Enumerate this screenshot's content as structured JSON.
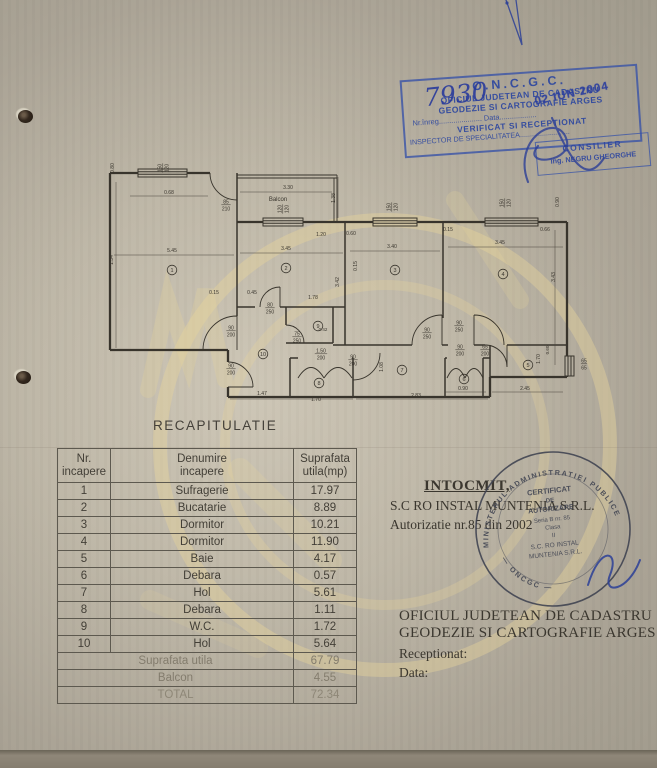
{
  "stamp_oncgc": {
    "title": "O.N.C.G.C.",
    "line1": "OFICIUL JUDETEAN DE CADASTRU",
    "line2": "GEODEZIE SI CARTOGRAFIE ARGES",
    "reg_line": "Nr.înreg..................... Data..................",
    "line3": "VERIFICAT SI RECEPTIONAT",
    "line4": "INSPECTOR DE SPECIALITATEA.........................",
    "handwritten_number": "7930",
    "date_stamp": "02 IUN 2004",
    "ink_color": "#3651a8"
  },
  "stamp_consilier": {
    "line1": "CONSILIER",
    "line2": "ing. NEGRU GHEORGHE"
  },
  "round_stamp": {
    "ring_top": "MINISTERUL  ADMINISTRATIEI  PUBLICE",
    "ring_bottom": "— ONCGC —",
    "center_lines": [
      "CERTIFICAT",
      "DE",
      "AUTORIZARE",
      "Seria B  nr. 85",
      "Clasa",
      "II",
      "S.C. RO INSTAL",
      "MUNTENIA S.R.L."
    ],
    "ink_color": "#3e4250"
  },
  "plan": {
    "rooms": [
      {
        "n": "1",
        "x": 72,
        "y": 110
      },
      {
        "n": "2",
        "x": 186,
        "y": 108
      },
      {
        "n": "3",
        "x": 295,
        "y": 110
      },
      {
        "n": "4",
        "x": 403,
        "y": 114
      },
      {
        "n": "5",
        "x": 428,
        "y": 205
      },
      {
        "n": "6",
        "x": 364,
        "y": 219
      },
      {
        "n": "7",
        "x": 302,
        "y": 210
      },
      {
        "n": "8",
        "x": 219,
        "y": 223
      },
      {
        "n": "9",
        "x": 218,
        "y": 166
      },
      {
        "n": "10",
        "x": 163,
        "y": 194
      }
    ],
    "labels": [
      {
        "t": "150/120",
        "x": 62,
        "y": 8,
        "r": -90,
        "f": 1
      },
      {
        "t": "0.80",
        "x": 14,
        "y": 8,
        "r": -90
      },
      {
        "t": "0.68",
        "x": 69,
        "y": 34
      },
      {
        "t": "1.34",
        "x": 13,
        "y": 100,
        "r": -90
      },
      {
        "t": "5.45",
        "x": 72,
        "y": 92
      },
      {
        "t": "85/210",
        "x": 126,
        "y": 44,
        "f": 1
      },
      {
        "t": "Balcon",
        "x": 178,
        "y": 41,
        "fs": 6
      },
      {
        "t": "3.30",
        "x": 188,
        "y": 29
      },
      {
        "t": "1.38",
        "x": 235,
        "y": 38,
        "r": -90
      },
      {
        "t": "120/120",
        "x": 182,
        "y": 49,
        "r": -90,
        "f": 1
      },
      {
        "t": "150/120",
        "x": 291,
        "y": 47,
        "r": -90,
        "f": 1
      },
      {
        "t": "150/120",
        "x": 404,
        "y": 43,
        "r": -90,
        "f": 1
      },
      {
        "t": "1.20",
        "x": 221,
        "y": 76
      },
      {
        "t": "0.60",
        "x": 251,
        "y": 75
      },
      {
        "t": "0.15",
        "x": 348,
        "y": 71
      },
      {
        "t": "0.66",
        "x": 445,
        "y": 71
      },
      {
        "t": "0.90",
        "x": 459,
        "y": 42,
        "r": -90
      },
      {
        "t": "3.45",
        "x": 186,
        "y": 90
      },
      {
        "t": "3.40",
        "x": 292,
        "y": 88
      },
      {
        "t": "3.45",
        "x": 400,
        "y": 84
      },
      {
        "t": "3.42",
        "x": 239,
        "y": 122,
        "r": -90
      },
      {
        "t": "0.15",
        "x": 257,
        "y": 106,
        "r": -90
      },
      {
        "t": "0.15",
        "x": 114,
        "y": 134
      },
      {
        "t": "0.45",
        "x": 152,
        "y": 134
      },
      {
        "t": "80/250",
        "x": 170,
        "y": 147,
        "f": 1
      },
      {
        "t": "1.78",
        "x": 213,
        "y": 139
      },
      {
        "t": "75/250",
        "x": 197,
        "y": 176,
        "f": 1
      },
      {
        "t": "0.42",
        "x": 223,
        "y": 171,
        "fs": 4.5
      },
      {
        "t": "90/200",
        "x": 131,
        "y": 170,
        "f": 1
      },
      {
        "t": "90/200",
        "x": 131,
        "y": 208,
        "f": 1
      },
      {
        "t": "1.50/200",
        "x": 221,
        "y": 193,
        "f": 1
      },
      {
        "t": "90/200",
        "x": 253,
        "y": 199,
        "f": 1
      },
      {
        "t": "1.47",
        "x": 162,
        "y": 235
      },
      {
        "t": "1.70",
        "x": 216,
        "y": 241
      },
      {
        "t": "2.83",
        "x": 316,
        "y": 237
      },
      {
        "t": "1.08",
        "x": 283,
        "y": 207,
        "r": -90
      },
      {
        "t": "90/250",
        "x": 327,
        "y": 172,
        "f": 1
      },
      {
        "t": "90/250",
        "x": 359,
        "y": 165,
        "f": 1
      },
      {
        "t": "90/200",
        "x": 360,
        "y": 189,
        "f": 1
      },
      {
        "t": "65/200",
        "x": 385,
        "y": 189,
        "f": 1
      },
      {
        "t": "0.90",
        "x": 363,
        "y": 230
      },
      {
        "t": "2.45",
        "x": 425,
        "y": 230
      },
      {
        "t": "65/65",
        "x": 484,
        "y": 203,
        "f": 1
      },
      {
        "t": "3.43",
        "x": 455,
        "y": 117,
        "r": -90
      },
      {
        "t": "1.70",
        "x": 440,
        "y": 199,
        "r": -90
      },
      {
        "t": "0.60",
        "x": 449,
        "y": 190,
        "r": -90,
        "fs": 4.5
      }
    ]
  },
  "recap": {
    "title": "RECAPITULATIE",
    "headers": {
      "c1a": "Nr.",
      "c1b": "incapere",
      "c2a": "Denumire",
      "c2b": "incapere",
      "c3a": "Suprafata",
      "c3b": "utila(mp)"
    },
    "rows": [
      [
        "1",
        "Sufragerie",
        "17.97"
      ],
      [
        "2",
        "Bucatarie",
        "8.89"
      ],
      [
        "3",
        "Dormitor",
        "10.21"
      ],
      [
        "4",
        "Dormitor",
        "11.90"
      ],
      [
        "5",
        "Baie",
        "4.17"
      ],
      [
        "6",
        "Debara",
        "0.57"
      ],
      [
        "7",
        "Hol",
        "5.61"
      ],
      [
        "8",
        "Debara",
        "1.11"
      ],
      [
        "9",
        "W.C.",
        "1.72"
      ],
      [
        "10",
        "Hol",
        "5.64"
      ]
    ],
    "summary": [
      [
        "Suprafata utila",
        "67.79"
      ],
      [
        "Balcon",
        "4.55"
      ],
      [
        "TOTAL",
        "72.34"
      ]
    ]
  },
  "intocmit": {
    "l1": "INTOCMIT,",
    "l2": "S.C RO INSTAL MUNTENIA S.R.L.",
    "l3": "Autorizatie nr.85   din 2002"
  },
  "footer": {
    "l1": "OFICIUL  JUDETEAN DE CADASTRU",
    "l2": "GEODEZIE SI CARTOGRAFIE ARGES",
    "l3": "Receptionat:",
    "l4": "Data:"
  }
}
